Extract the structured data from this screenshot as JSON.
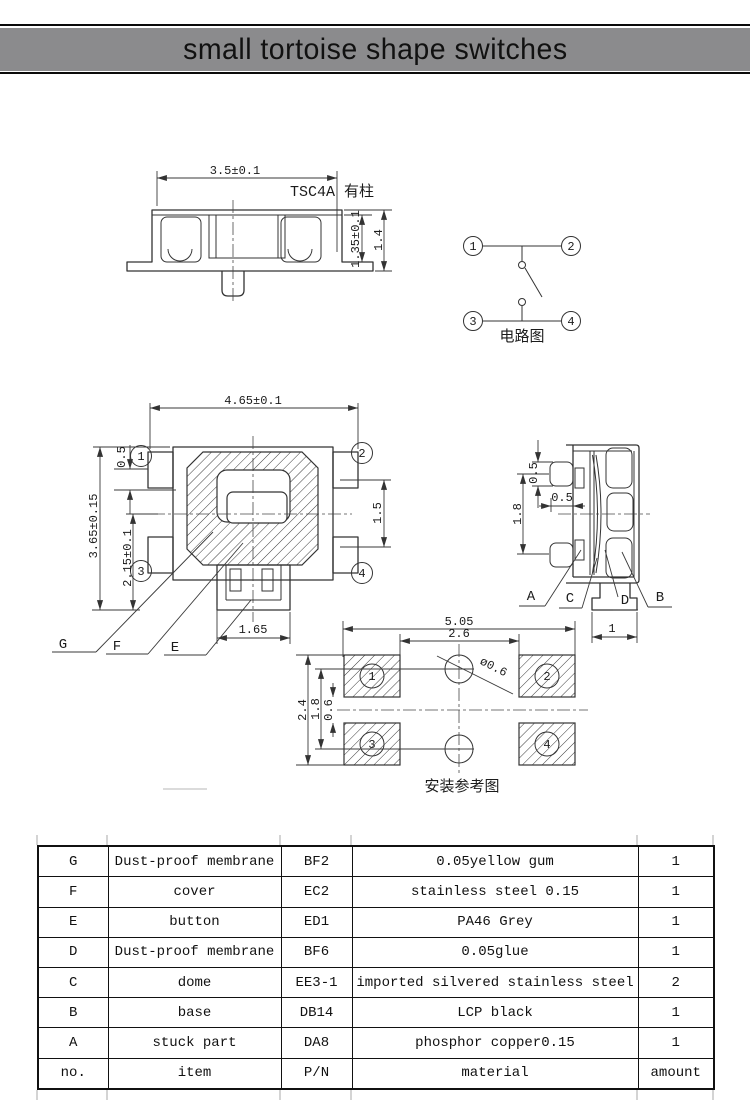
{
  "page": {
    "title": "small tortoise shape switches",
    "bar_color": "#8b8b8d"
  },
  "side_view_front": {
    "model_label": "TSC4A 有柱",
    "dim_width": "3.5±0.1",
    "dim_body_height": "1.35±0.1",
    "dim_total_height": "1.4"
  },
  "circuit_diagram": {
    "caption": "电路图",
    "pin_1": "1",
    "pin_2": "2",
    "pin_3": "3",
    "pin_4": "4"
  },
  "top_view": {
    "dim_width": "4.65±0.1",
    "dim_height": "3.65±0.15",
    "dim_lower_height": "2.15±0.1",
    "dim_corner_offset": "0.5",
    "dim_button_height": "1.5",
    "dim_stem_width": "1.65",
    "pin_1": "1",
    "pin_2": "2",
    "pin_3": "3",
    "pin_4": "4",
    "label_g": "G",
    "label_f": "F",
    "label_e": "E"
  },
  "side_view_right": {
    "dim_terminal_thickness": "0.5",
    "dim_terminal_length": "0.5",
    "dim_terminal_pitch": "1.8",
    "dim_foot_width": "1",
    "label_a": "A",
    "label_c": "C",
    "label_d": "D",
    "label_b": "B"
  },
  "mounting_view": {
    "caption": "安装参考图",
    "dim_outer_width": "5.05",
    "dim_pad_gap_width": "2.6",
    "dim_outer_height": "2.4",
    "dim_hole_pitch": "1.8",
    "dim_pad_gap_height": "0.6",
    "dim_hole_diameter": "ø0.6",
    "pad_1": "1",
    "pad_2": "2",
    "pad_3": "3",
    "pad_4": "4"
  },
  "parts_table": {
    "columns": {
      "no": "no.",
      "item": "item",
      "pn": "P/N",
      "material": "material",
      "amount": "amount"
    },
    "rows": [
      {
        "no": "G",
        "item": "Dust-proof membrane",
        "pn": "BF2",
        "material": "0.05yellow gum",
        "amount": "1"
      },
      {
        "no": "F",
        "item": "cover",
        "pn": "EC2",
        "material": "stainless steel 0.15",
        "amount": "1"
      },
      {
        "no": "E",
        "item": "button",
        "pn": "ED1",
        "material": "PA46 Grey",
        "amount": "1"
      },
      {
        "no": "D",
        "item": "Dust-proof membrane",
        "pn": "BF6",
        "material": "0.05glue",
        "amount": "1"
      },
      {
        "no": "C",
        "item": "dome",
        "pn": "EE3-1",
        "material": "imported silvered stainless steel",
        "amount": "2"
      },
      {
        "no": "B",
        "item": "base",
        "pn": "DB14",
        "material": "LCP black",
        "amount": "1"
      },
      {
        "no": "A",
        "item": "stuck part",
        "pn": "DA8",
        "material": "phosphor copper0.15",
        "amount": "1"
      }
    ]
  }
}
